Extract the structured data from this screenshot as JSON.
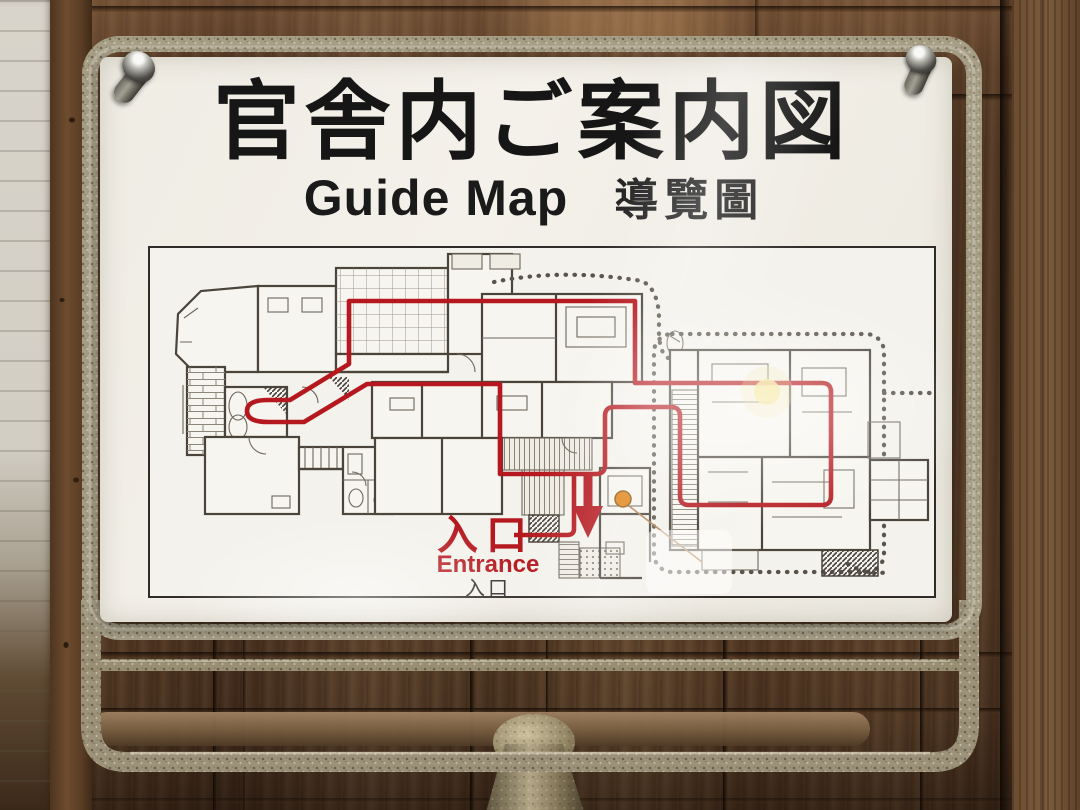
{
  "sign": {
    "title_jp": "官舎内ご案内図",
    "title_en": "Guide Map",
    "title_zh": "導覽圖"
  },
  "map": {
    "entrance_jp": "入口",
    "entrance_en": "Entrance",
    "entrance_jp_alt": "入口",
    "route_color": "#b5191f",
    "marker_color": "#e08010"
  },
  "colors": {
    "sign_background": "#f2efe8",
    "frame_metal": "#a79e86",
    "wood_wall": "#583c28"
  }
}
